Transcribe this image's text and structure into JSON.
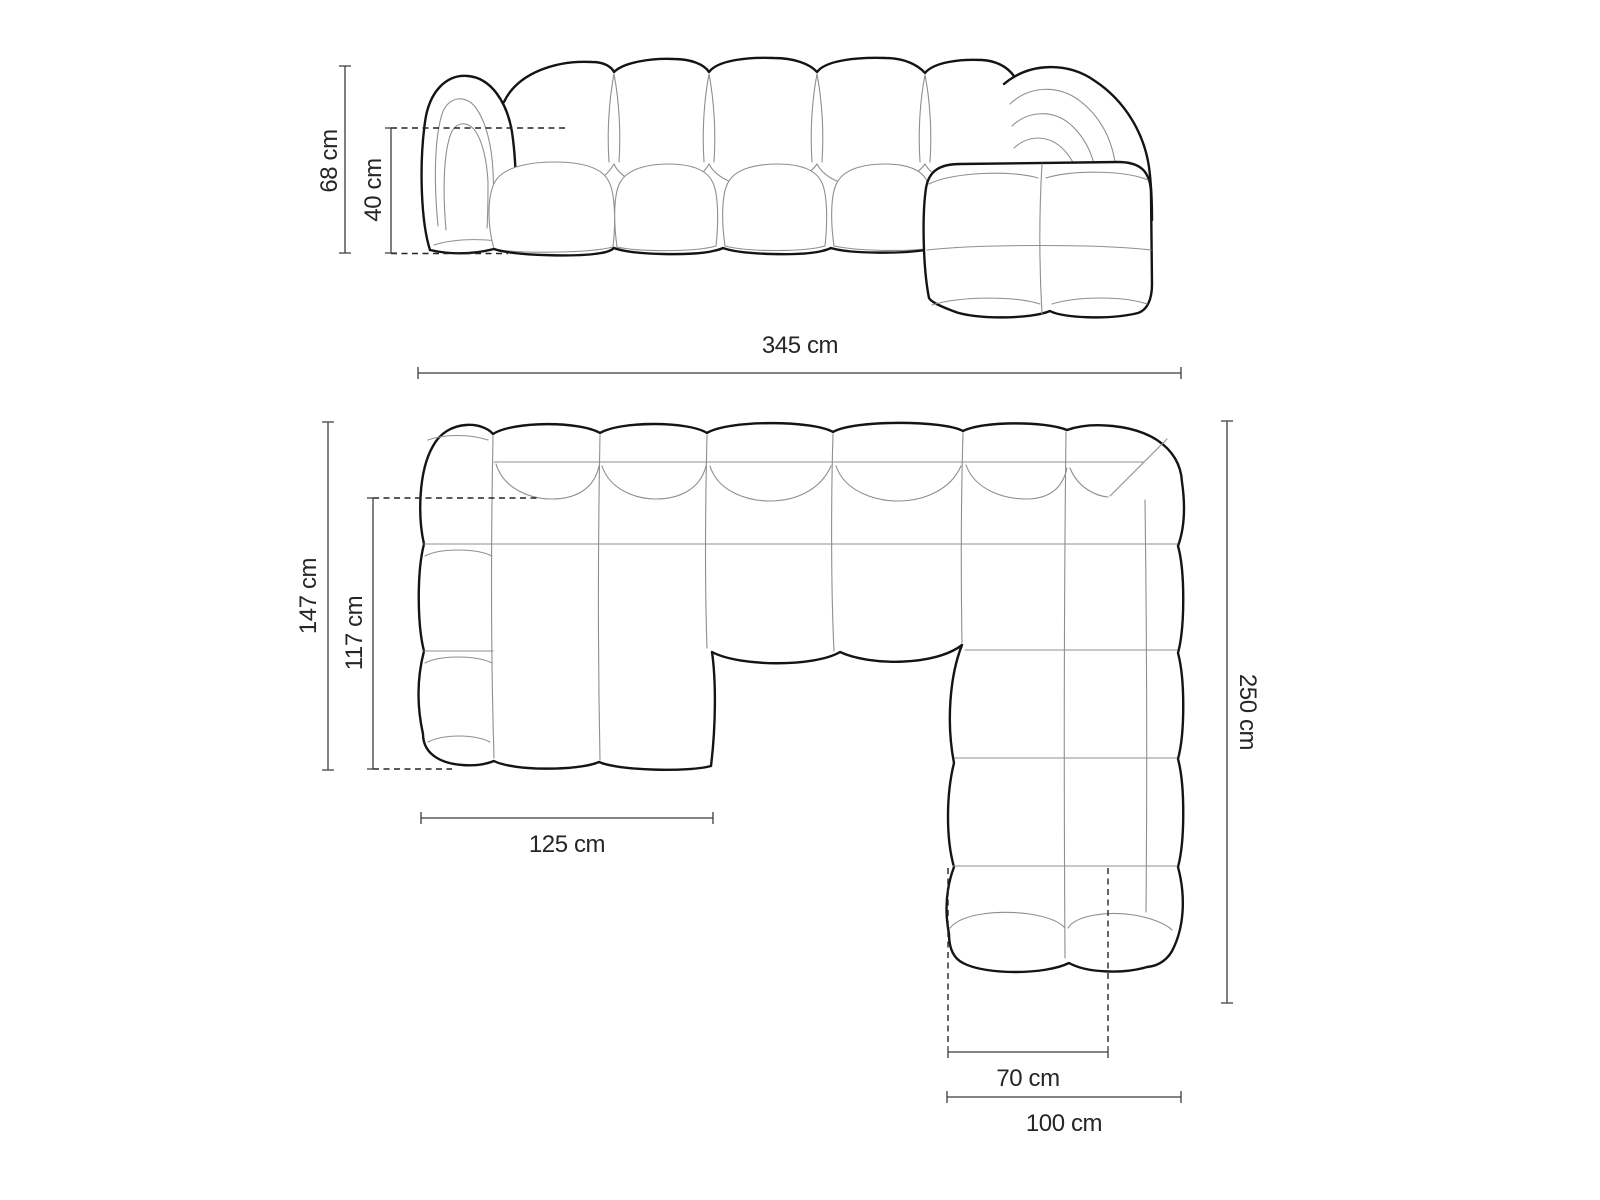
{
  "colors": {
    "background": "#ffffff",
    "sofa_outline": "#141414",
    "sofa_seam": "#8f8f8f",
    "dimension_line": "#3c3c3c",
    "label_text": "#262626"
  },
  "diagram": {
    "type": "furniture-dimension-drawing",
    "subject": "modular-bubble-corner-sofa",
    "views": {
      "front": {
        "name": "front-elevation-view",
        "dimensions": {
          "overall_height": {
            "label": "68 cm",
            "value": 68,
            "unit": "cm",
            "orientation": "vertical"
          },
          "seat_height": {
            "label": "40 cm",
            "value": 40,
            "unit": "cm",
            "orientation": "vertical"
          },
          "overall_width": {
            "label": "345 cm",
            "value": 345,
            "unit": "cm",
            "orientation": "horizontal"
          }
        }
      },
      "top": {
        "name": "top-plan-view",
        "dimensions": {
          "left_section_depth": {
            "label": "147 cm",
            "value": 147,
            "unit": "cm",
            "orientation": "vertical"
          },
          "left_section_inner_depth": {
            "label": "117 cm",
            "value": 117,
            "unit": "cm",
            "orientation": "vertical"
          },
          "left_section_width": {
            "label": "125 cm",
            "value": 125,
            "unit": "cm",
            "orientation": "horizontal"
          },
          "right_section_depth": {
            "label": "250 cm",
            "value": 250,
            "unit": "cm",
            "orientation": "vertical"
          },
          "chaise_seat_width": {
            "label": "70 cm",
            "value": 70,
            "unit": "cm",
            "orientation": "horizontal"
          },
          "chaise_total_width": {
            "label": "100 cm",
            "value": 100,
            "unit": "cm",
            "orientation": "horizontal"
          }
        }
      }
    }
  }
}
